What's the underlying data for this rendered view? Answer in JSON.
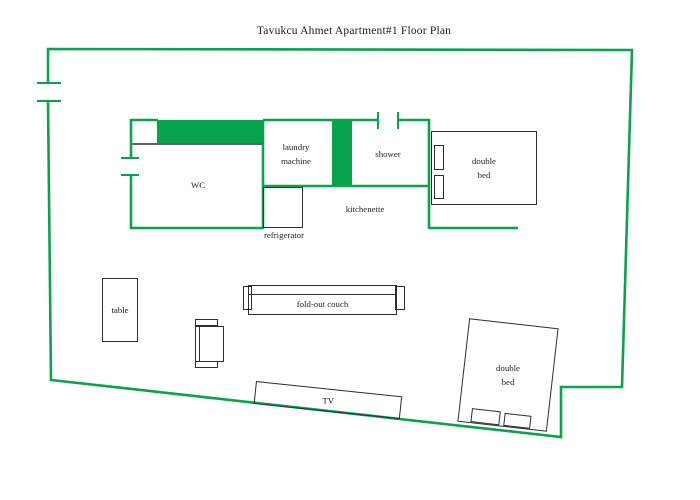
{
  "title": "Tavukcu Ahmet Apartment#1 Floor Plan",
  "colors": {
    "wall": "#0aa34d",
    "line": "#2e2e2e",
    "text": "#1d1d1d"
  },
  "labels": {
    "wc": "WC",
    "laundry_machine": "laundry\nmachine",
    "shower": "shower",
    "kitchenette": "kitchenette",
    "refrigerator": "refrigerator",
    "double_bed_top": "double\nbed",
    "table": "table",
    "fold_out_couch": "fold-out couch",
    "tv": "TV",
    "double_bed_bottom": "double\nbed"
  }
}
